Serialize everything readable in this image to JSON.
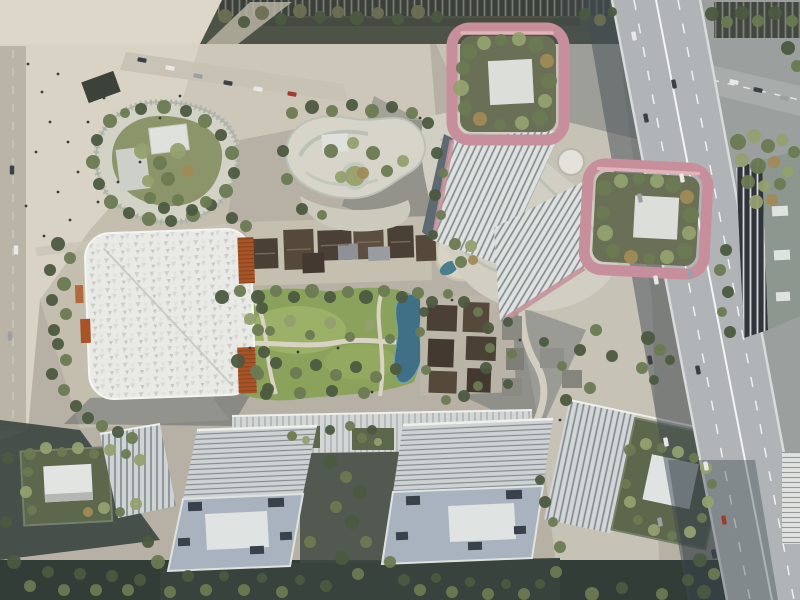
{
  "scene": {
    "title": "Aerial masterplan rendering",
    "description": "Bird's-eye architectural rendering of a mixed-use city block: two high-rise towers crowned by rose-pink rooftop garden frames with white roof pads, an organic podium with roof gardens, a white gridshell-roofed hall with orange louvre panels, a central lawn with preserved low courtyard houses, winding paths, a stream and a circular sunken garden, slab office blocks along the south edge, and an elevated expressway with traffic along the east edge."
  },
  "palette": {
    "plaza_light": "#dcd7c9",
    "plaza_mid": "#c6c1b2",
    "ground_base": "#b6b1a4",
    "street_dark": "#4e5348",
    "lawn_green": "#8aa25b",
    "pond_blue": "#3f7086",
    "rose_frame": "#c78f9b",
    "rose_highlight": "#e3b3ba",
    "roof_garden": "#6a7055",
    "white_pad": "#dfe3e2",
    "tower_facade": "#dfe1df",
    "tower_rib": "#7f8a8e",
    "canopy_white": "#e9e9e5",
    "orange_louver": "#a85427",
    "heritage_roof": "#4b4036",
    "slab_roof": "#ced2d3",
    "slab_body": "#a9b3bf",
    "highway_deck": "#b0b4b6",
    "shadow": "#414c54",
    "tree_dark": "#4c5a40"
  },
  "tree_colors": {
    "1": "#4c5a40",
    "2": "#6c7a52",
    "3": "#93a06f",
    "4": "#6d6f52",
    "5": "#a08a56"
  },
  "vehicle_colors": {
    "1": "#e8e8e6",
    "2": "#3a4046",
    "3": "#9aa0a3",
    "4": "#a23b2f"
  },
  "trees": [
    [
      225,
      16,
      7,
      4
    ],
    [
      244,
      22,
      6,
      1
    ],
    [
      262,
      13,
      7,
      4
    ],
    [
      281,
      19,
      6,
      1
    ],
    [
      300,
      11,
      7,
      4
    ],
    [
      320,
      17,
      6,
      1
    ],
    [
      338,
      12,
      6,
      4
    ],
    [
      357,
      18,
      7,
      1
    ],
    [
      378,
      13,
      6,
      4
    ],
    [
      398,
      19,
      6,
      1
    ],
    [
      418,
      12,
      7,
      4
    ],
    [
      437,
      17,
      6,
      1
    ],
    [
      585,
      14,
      6,
      1
    ],
    [
      600,
      20,
      6,
      4
    ],
    [
      612,
      12,
      5,
      1
    ],
    [
      712,
      14,
      7,
      1
    ],
    [
      727,
      22,
      6,
      2
    ],
    [
      742,
      13,
      7,
      1
    ],
    [
      758,
      21,
      6,
      2
    ],
    [
      775,
      13,
      7,
      1
    ],
    [
      792,
      21,
      6,
      2
    ],
    [
      788,
      48,
      7,
      1
    ],
    [
      797,
      66,
      6,
      2
    ],
    [
      738,
      142,
      8,
      2
    ],
    [
      754,
      136,
      7,
      3
    ],
    [
      768,
      146,
      7,
      2
    ],
    [
      782,
      140,
      6,
      3
    ],
    [
      794,
      152,
      6,
      2
    ],
    [
      742,
      160,
      7,
      3
    ],
    [
      758,
      166,
      8,
      2
    ],
    [
      774,
      162,
      6,
      5
    ],
    [
      788,
      172,
      6,
      3
    ],
    [
      748,
      182,
      7,
      2
    ],
    [
      764,
      186,
      6,
      3
    ],
    [
      780,
      184,
      6,
      2
    ],
    [
      756,
      202,
      7,
      3
    ],
    [
      772,
      200,
      6,
      5
    ],
    [
      726,
      250,
      6,
      1
    ],
    [
      720,
      270,
      6,
      2
    ],
    [
      728,
      292,
      6,
      1
    ],
    [
      722,
      312,
      5,
      2
    ],
    [
      730,
      332,
      6,
      1
    ],
    [
      648,
      338,
      7,
      1
    ],
    [
      660,
      350,
      6,
      2
    ],
    [
      670,
      360,
      5,
      1
    ],
    [
      642,
      368,
      6,
      2
    ],
    [
      654,
      380,
      5,
      1
    ],
    [
      700,
      560,
      7,
      1
    ],
    [
      714,
      574,
      6,
      2
    ],
    [
      688,
      580,
      6,
      1
    ],
    [
      704,
      592,
      7,
      1
    ],
    [
      662,
      594,
      6,
      2
    ],
    [
      622,
      588,
      6,
      1
    ],
    [
      592,
      594,
      7,
      2
    ],
    [
      469,
      52,
      8,
      2
    ],
    [
      484,
      43,
      7,
      3
    ],
    [
      501,
      40,
      6,
      2
    ],
    [
      519,
      39,
      7,
      3
    ],
    [
      536,
      45,
      8,
      2
    ],
    [
      547,
      61,
      7,
      5
    ],
    [
      549,
      81,
      8,
      2
    ],
    [
      545,
      101,
      7,
      3
    ],
    [
      540,
      118,
      8,
      2
    ],
    [
      522,
      123,
      7,
      3
    ],
    [
      500,
      125,
      6,
      2
    ],
    [
      480,
      119,
      7,
      5
    ],
    [
      465,
      108,
      7,
      2
    ],
    [
      461,
      88,
      8,
      3
    ],
    [
      463,
      68,
      7,
      2
    ],
    [
      604,
      188,
      8,
      2
    ],
    [
      621,
      181,
      7,
      3
    ],
    [
      639,
      179,
      6,
      2
    ],
    [
      657,
      181,
      7,
      3
    ],
    [
      673,
      185,
      8,
      2
    ],
    [
      687,
      197,
      7,
      5
    ],
    [
      691,
      215,
      8,
      2
    ],
    [
      689,
      233,
      7,
      3
    ],
    [
      685,
      251,
      8,
      2
    ],
    [
      667,
      257,
      7,
      3
    ],
    [
      649,
      259,
      6,
      2
    ],
    [
      631,
      257,
      7,
      5
    ],
    [
      613,
      251,
      7,
      2
    ],
    [
      605,
      233,
      8,
      3
    ],
    [
      603,
      213,
      7,
      2
    ],
    [
      110,
      121,
      7,
      2
    ],
    [
      97,
      140,
      6,
      1
    ],
    [
      93,
      162,
      7,
      2
    ],
    [
      99,
      184,
      6,
      1
    ],
    [
      111,
      202,
      7,
      2
    ],
    [
      129,
      213,
      6,
      1
    ],
    [
      149,
      219,
      7,
      2
    ],
    [
      171,
      221,
      6,
      1
    ],
    [
      193,
      215,
      7,
      2
    ],
    [
      211,
      205,
      6,
      1
    ],
    [
      226,
      191,
      7,
      2
    ],
    [
      234,
      173,
      6,
      1
    ],
    [
      232,
      153,
      7,
      2
    ],
    [
      221,
      135,
      6,
      1
    ],
    [
      205,
      121,
      7,
      2
    ],
    [
      186,
      111,
      6,
      1
    ],
    [
      164,
      107,
      7,
      2
    ],
    [
      141,
      109,
      6,
      1
    ],
    [
      125,
      113,
      5,
      2
    ],
    [
      142,
      151,
      8,
      3
    ],
    [
      160,
      163,
      7,
      2
    ],
    [
      178,
      151,
      8,
      3
    ],
    [
      168,
      179,
      7,
      2
    ],
    [
      148,
      181,
      6,
      3
    ],
    [
      188,
      171,
      6,
      5
    ],
    [
      292,
      113,
      6,
      2
    ],
    [
      312,
      107,
      7,
      1
    ],
    [
      332,
      111,
      6,
      2
    ],
    [
      352,
      105,
      6,
      1
    ],
    [
      372,
      111,
      7,
      2
    ],
    [
      392,
      107,
      6,
      1
    ],
    [
      412,
      113,
      6,
      2
    ],
    [
      428,
      123,
      6,
      1
    ],
    [
      283,
      151,
      6,
      1
    ],
    [
      287,
      179,
      6,
      2
    ],
    [
      302,
      209,
      6,
      1
    ],
    [
      322,
      215,
      5,
      2
    ],
    [
      331,
      151,
      7,
      2
    ],
    [
      353,
      143,
      6,
      3
    ],
    [
      373,
      153,
      7,
      2
    ],
    [
      341,
      177,
      6,
      3
    ],
    [
      363,
      173,
      6,
      5
    ],
    [
      387,
      171,
      6,
      2
    ],
    [
      403,
      161,
      6,
      3
    ],
    [
      437,
      153,
      6,
      1
    ],
    [
      443,
      173,
      5,
      2
    ],
    [
      435,
      195,
      6,
      1
    ],
    [
      441,
      215,
      5,
      2
    ],
    [
      433,
      235,
      5,
      1
    ],
    [
      222,
      297,
      7,
      1
    ],
    [
      240,
      291,
      6,
      2
    ],
    [
      258,
      297,
      7,
      1
    ],
    [
      276,
      291,
      6,
      2
    ],
    [
      294,
      297,
      6,
      1
    ],
    [
      312,
      291,
      7,
      2
    ],
    [
      330,
      297,
      6,
      1
    ],
    [
      348,
      292,
      6,
      2
    ],
    [
      366,
      297,
      7,
      1
    ],
    [
      384,
      291,
      6,
      2
    ],
    [
      402,
      297,
      6,
      1
    ],
    [
      418,
      293,
      6,
      2
    ],
    [
      250,
      319,
      6,
      3
    ],
    [
      270,
      331,
      5,
      2
    ],
    [
      290,
      321,
      6,
      3
    ],
    [
      310,
      335,
      5,
      2
    ],
    [
      330,
      323,
      6,
      3
    ],
    [
      350,
      337,
      5,
      2
    ],
    [
      370,
      325,
      6,
      3
    ],
    [
      390,
      339,
      5,
      2
    ],
    [
      238,
      361,
      7,
      1
    ],
    [
      256,
      371,
      6,
      2
    ],
    [
      276,
      363,
      6,
      1
    ],
    [
      296,
      373,
      6,
      2
    ],
    [
      316,
      365,
      6,
      1
    ],
    [
      336,
      375,
      6,
      2
    ],
    [
      356,
      367,
      6,
      1
    ],
    [
      376,
      377,
      6,
      2
    ],
    [
      396,
      369,
      6,
      1
    ],
    [
      268,
      389,
      6,
      1
    ],
    [
      300,
      393,
      6,
      2
    ],
    [
      332,
      391,
      6,
      1
    ],
    [
      364,
      393,
      6,
      2
    ],
    [
      432,
      302,
      6,
      1
    ],
    [
      448,
      294,
      5,
      2
    ],
    [
      464,
      302,
      6,
      1
    ],
    [
      478,
      312,
      5,
      2
    ],
    [
      488,
      328,
      6,
      1
    ],
    [
      490,
      348,
      5,
      2
    ],
    [
      486,
      368,
      6,
      1
    ],
    [
      478,
      386,
      5,
      2
    ],
    [
      464,
      396,
      6,
      1
    ],
    [
      446,
      400,
      5,
      2
    ],
    [
      455,
      244,
      6,
      2
    ],
    [
      471,
      246,
      6,
      3
    ],
    [
      461,
      262,
      6,
      2
    ],
    [
      473,
      260,
      5,
      5
    ],
    [
      424,
      312,
      5,
      1
    ],
    [
      420,
      332,
      5,
      2
    ],
    [
      508,
      322,
      5,
      1
    ],
    [
      512,
      354,
      5,
      2
    ],
    [
      508,
      384,
      5,
      1
    ],
    [
      426,
      370,
      5,
      2
    ],
    [
      544,
      342,
      5,
      1
    ],
    [
      562,
      366,
      5,
      2
    ],
    [
      580,
      350,
      6,
      1
    ],
    [
      596,
      330,
      6,
      2
    ],
    [
      612,
      356,
      6,
      1
    ],
    [
      590,
      388,
      6,
      2
    ],
    [
      566,
      400,
      6,
      1
    ],
    [
      330,
      462,
      7,
      1
    ],
    [
      346,
      477,
      6,
      2
    ],
    [
      360,
      492,
      7,
      1
    ],
    [
      336,
      507,
      6,
      2
    ],
    [
      352,
      522,
      7,
      1
    ],
    [
      366,
      542,
      6,
      2
    ],
    [
      342,
      558,
      7,
      1
    ],
    [
      358,
      574,
      6,
      2
    ],
    [
      326,
      586,
      6,
      1
    ],
    [
      390,
      562,
      6,
      2
    ],
    [
      404,
      580,
      6,
      1
    ],
    [
      310,
      542,
      6,
      2
    ],
    [
      148,
      542,
      6,
      1
    ],
    [
      158,
      562,
      7,
      2
    ],
    [
      140,
      580,
      6,
      1
    ],
    [
      170,
      592,
      6,
      2
    ],
    [
      188,
      576,
      6,
      1
    ],
    [
      206,
      590,
      6,
      2
    ],
    [
      224,
      576,
      5,
      1
    ],
    [
      244,
      590,
      6,
      2
    ],
    [
      262,
      578,
      5,
      1
    ],
    [
      282,
      592,
      6,
      2
    ],
    [
      300,
      580,
      5,
      1
    ],
    [
      420,
      590,
      6,
      2
    ],
    [
      436,
      578,
      5,
      1
    ],
    [
      452,
      592,
      6,
      2
    ],
    [
      470,
      582,
      5,
      1
    ],
    [
      488,
      594,
      6,
      2
    ],
    [
      506,
      584,
      5,
      1
    ],
    [
      524,
      594,
      6,
      2
    ],
    [
      540,
      584,
      5,
      1
    ],
    [
      556,
      572,
      6,
      2
    ],
    [
      545,
      502,
      6,
      1
    ],
    [
      553,
      522,
      5,
      2
    ],
    [
      540,
      480,
      5,
      1
    ],
    [
      560,
      547,
      6,
      2
    ],
    [
      30,
      454,
      6,
      2
    ],
    [
      46,
      448,
      6,
      3
    ],
    [
      62,
      452,
      5,
      2
    ],
    [
      78,
      448,
      6,
      3
    ],
    [
      94,
      454,
      5,
      2
    ],
    [
      110,
      450,
      6,
      3
    ],
    [
      126,
      454,
      5,
      2
    ],
    [
      140,
      460,
      6,
      3
    ],
    [
      28,
      472,
      5,
      2
    ],
    [
      26,
      492,
      6,
      3
    ],
    [
      32,
      510,
      5,
      2
    ],
    [
      104,
      508,
      6,
      3
    ],
    [
      120,
      512,
      5,
      2
    ],
    [
      136,
      504,
      6,
      3
    ],
    [
      88,
      512,
      5,
      5
    ],
    [
      630,
      450,
      6,
      2
    ],
    [
      646,
      444,
      6,
      3
    ],
    [
      662,
      448,
      5,
      2
    ],
    [
      678,
      452,
      6,
      3
    ],
    [
      694,
      458,
      5,
      2
    ],
    [
      706,
      468,
      6,
      3
    ],
    [
      712,
      484,
      5,
      2
    ],
    [
      708,
      502,
      6,
      3
    ],
    [
      702,
      518,
      5,
      2
    ],
    [
      690,
      532,
      6,
      3
    ],
    [
      672,
      536,
      5,
      2
    ],
    [
      654,
      530,
      6,
      3
    ],
    [
      638,
      520,
      5,
      2
    ],
    [
      630,
      502,
      6,
      3
    ],
    [
      626,
      484,
      5,
      2
    ],
    [
      58,
      244,
      7,
      1
    ],
    [
      70,
      258,
      6,
      2
    ],
    [
      50,
      270,
      6,
      1
    ],
    [
      64,
      284,
      7,
      2
    ],
    [
      52,
      300,
      6,
      1
    ],
    [
      66,
      314,
      6,
      2
    ],
    [
      54,
      330,
      6,
      1
    ],
    [
      150,
      198,
      6,
      2
    ],
    [
      164,
      208,
      6,
      1
    ],
    [
      178,
      200,
      6,
      2
    ],
    [
      192,
      210,
      6,
      1
    ],
    [
      206,
      202,
      6,
      2
    ],
    [
      232,
      218,
      6,
      1
    ],
    [
      246,
      226,
      6,
      2
    ],
    [
      58,
      344,
      6,
      1
    ],
    [
      66,
      360,
      6,
      2
    ],
    [
      52,
      374,
      6,
      1
    ],
    [
      64,
      390,
      6,
      2
    ],
    [
      76,
      406,
      6,
      1
    ],
    [
      88,
      418,
      6,
      1
    ],
    [
      102,
      426,
      6,
      2
    ],
    [
      118,
      432,
      6,
      1
    ],
    [
      132,
      438,
      6,
      2
    ],
    [
      8,
      458,
      6,
      1
    ],
    [
      6,
      522,
      6,
      1
    ],
    [
      14,
      562,
      7,
      1
    ],
    [
      30,
      586,
      6,
      2
    ],
    [
      48,
      572,
      6,
      1
    ],
    [
      64,
      590,
      6,
      2
    ],
    [
      80,
      574,
      6,
      1
    ],
    [
      96,
      590,
      6,
      2
    ],
    [
      112,
      576,
      6,
      1
    ],
    [
      128,
      590,
      6,
      2
    ],
    [
      292,
      436,
      5,
      2
    ],
    [
      306,
      440,
      4,
      3
    ],
    [
      362,
      438,
      5,
      2
    ],
    [
      378,
      442,
      4,
      3
    ],
    [
      330,
      430,
      5,
      1
    ],
    [
      350,
      426,
      5,
      2
    ],
    [
      372,
      430,
      5,
      1
    ],
    [
      262,
      308,
      6,
      1
    ],
    [
      258,
      330,
      6,
      2
    ],
    [
      264,
      352,
      6,
      1
    ],
    [
      258,
      374,
      6,
      2
    ],
    [
      266,
      394,
      6,
      1
    ]
  ],
  "vehicles": [
    [
      634,
      36,
      -11,
      1
    ],
    [
      646,
      118,
      -11,
      2
    ],
    [
      640,
      198,
      -11,
      3
    ],
    [
      656,
      280,
      -11,
      1
    ],
    [
      650,
      360,
      -11,
      2
    ],
    [
      666,
      442,
      -11,
      1
    ],
    [
      660,
      522,
      -11,
      3
    ],
    [
      674,
      84,
      -11,
      2
    ],
    [
      682,
      178,
      -11,
      1
    ],
    [
      690,
      274,
      -11,
      3
    ],
    [
      698,
      370,
      -11,
      2
    ],
    [
      706,
      466,
      -11,
      1
    ],
    [
      714,
      554,
      -11,
      2
    ],
    [
      724,
      520,
      -11,
      4
    ],
    [
      734,
      82,
      102,
      1
    ],
    [
      758,
      90,
      102,
      2
    ],
    [
      784,
      98,
      102,
      3
    ],
    [
      142,
      60,
      100,
      2
    ],
    [
      170,
      68,
      100,
      1
    ],
    [
      198,
      76,
      100,
      3
    ],
    [
      228,
      83,
      100,
      2
    ],
    [
      258,
      89,
      100,
      1
    ],
    [
      292,
      94,
      100,
      4
    ],
    [
      12,
      170,
      0,
      2
    ],
    [
      16,
      250,
      0,
      1
    ],
    [
      10,
      336,
      0,
      3
    ]
  ],
  "pedestrians": [
    [
      28,
      64
    ],
    [
      42,
      92
    ],
    [
      58,
      74
    ],
    [
      50,
      122
    ],
    [
      36,
      152
    ],
    [
      68,
      142
    ],
    [
      88,
      122
    ],
    [
      104,
      98
    ],
    [
      78,
      172
    ],
    [
      58,
      192
    ],
    [
      98,
      202
    ],
    [
      118,
      182
    ],
    [
      26,
      206
    ],
    [
      140,
      162
    ],
    [
      160,
      118
    ],
    [
      180,
      96
    ],
    [
      44,
      236
    ],
    [
      70,
      220
    ],
    [
      250,
      348
    ],
    [
      298,
      352
    ],
    [
      338,
      348
    ],
    [
      372,
      392
    ],
    [
      420,
      118
    ],
    [
      452,
      300
    ],
    [
      520,
      340
    ],
    [
      560,
      420
    ]
  ]
}
